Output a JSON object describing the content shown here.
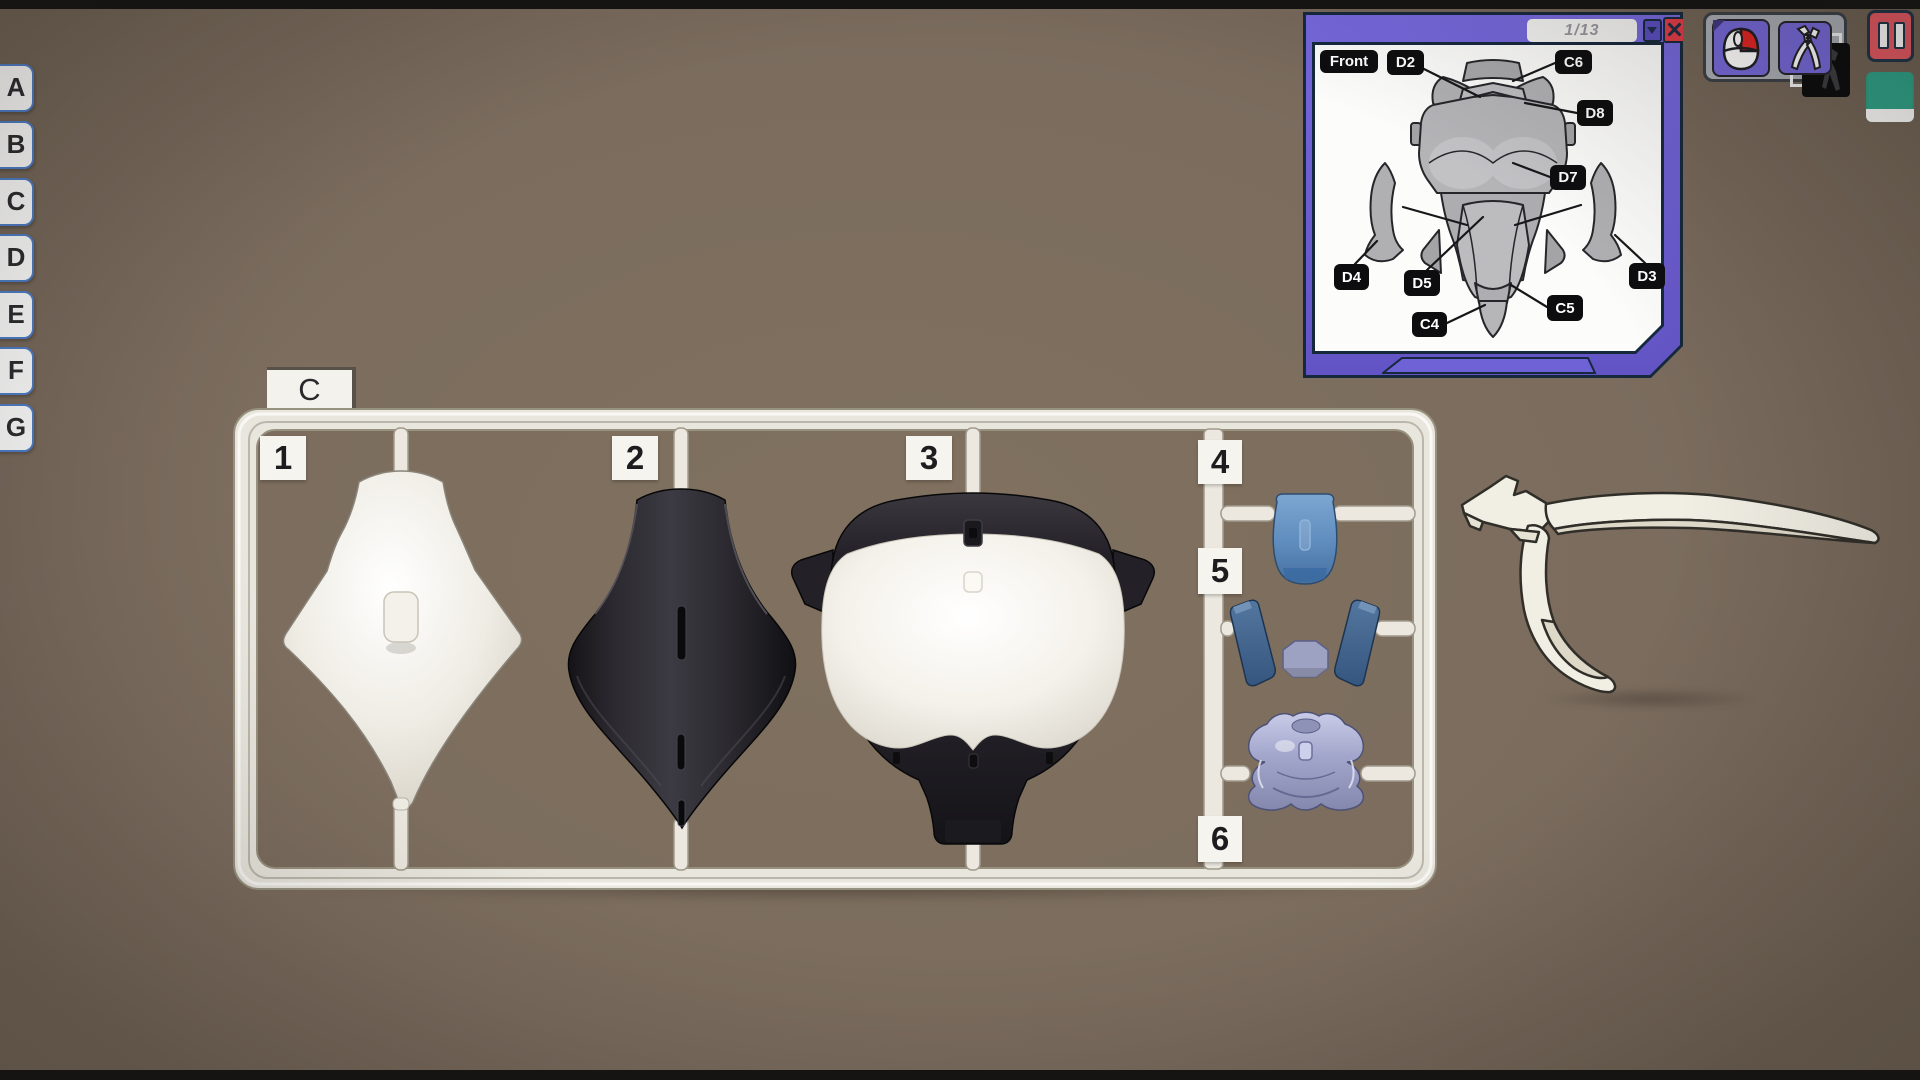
{
  "scene": {
    "background_color": "#7b6c5e",
    "letterbox_color": "#151413"
  },
  "left_tabs": {
    "items": [
      {
        "label": "A"
      },
      {
        "label": "B"
      },
      {
        "label": "C"
      },
      {
        "label": "D"
      },
      {
        "label": "E"
      },
      {
        "label": "F"
      },
      {
        "label": "G"
      }
    ]
  },
  "sprue": {
    "sheet_label": "C",
    "tags": {
      "t1": "1",
      "t2": "2",
      "t3": "3",
      "t4": "4",
      "t5": "5",
      "t6": "6"
    }
  },
  "manual": {
    "page_indicator": "1/13",
    "labels": {
      "front": "Front",
      "d2": "D2",
      "c6": "C6",
      "d8": "D8",
      "d7": "D7",
      "d4": "D4",
      "d5": "D5",
      "d3": "D3",
      "c4": "C4",
      "c5": "C5"
    },
    "icons": {
      "dropdown": "triangle-down-icon",
      "close": "x-icon"
    }
  },
  "toolbar": {
    "icons": {
      "mouse": "mouse-icon",
      "cutter": "nippers-icon"
    }
  },
  "hud": {
    "pause_icon": "pause-bars-icon",
    "flag_icon": "green-card-icon"
  },
  "colors": {
    "panel_purple": "#6a5bd0",
    "panel_outline": "#15283c",
    "close_red": "#e23b45",
    "pause_red": "#e65862",
    "flag_green": "#2ea287",
    "tab_outline_blue": "#4d7dc8",
    "sprue_plastic": "#e9e6de",
    "part1_white": "#efece4",
    "part2_black": "#232127",
    "part3_chest_white": "#f4f1ea",
    "part4_blue": "#5e8cbd",
    "part5_navy": "#35567e",
    "part6_lavender": "#a2a6cb"
  }
}
